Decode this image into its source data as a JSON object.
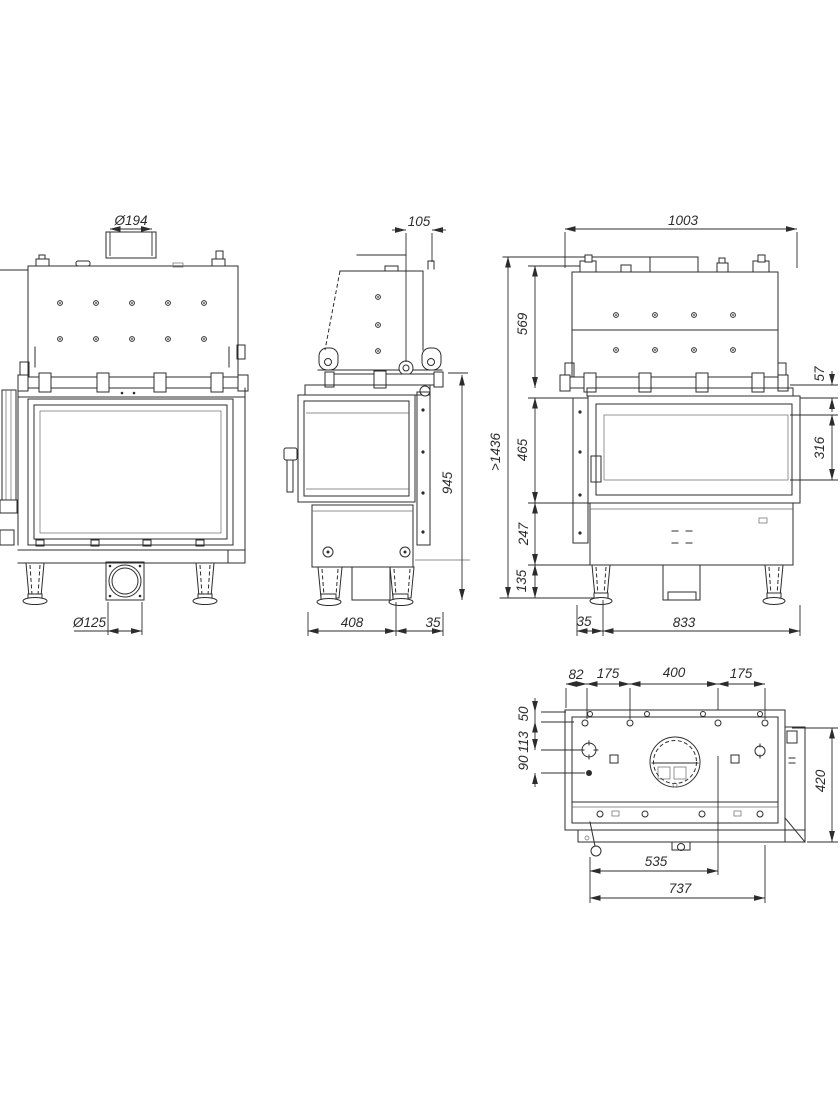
{
  "meta": {
    "type": "technical-drawing",
    "subject": "fireplace-insert-orthographic-views",
    "units": "mm",
    "line_color": "#2c2c2c",
    "background_color": "#ffffff"
  },
  "front_view": {
    "flue_diameter_top": "Ø194",
    "outlet_diameter_bottom": "Ø125"
  },
  "side_view": {
    "flue_center_offset": "105",
    "body_height": "945",
    "base_depth": "408",
    "rear_offset": "35"
  },
  "rear_view": {
    "overall_width": "1003",
    "hood_height": "569",
    "frame_height": "57",
    "min_total_height": ">1436",
    "firebox_height": "465",
    "glass_height": "316",
    "base_height": "247",
    "leg_height": "135",
    "side_offset": "35",
    "leg_span": "833"
  },
  "plan_view": {
    "edge_offset": "82",
    "hole_pitch_left": "175",
    "hole_pitch_center": "400",
    "hole_pitch_right": "175",
    "inset_top": "50",
    "inset_middle": "113",
    "inset_bottom": "90",
    "body_depth": "420",
    "flue_center_offset": "535",
    "base_width": "737"
  }
}
